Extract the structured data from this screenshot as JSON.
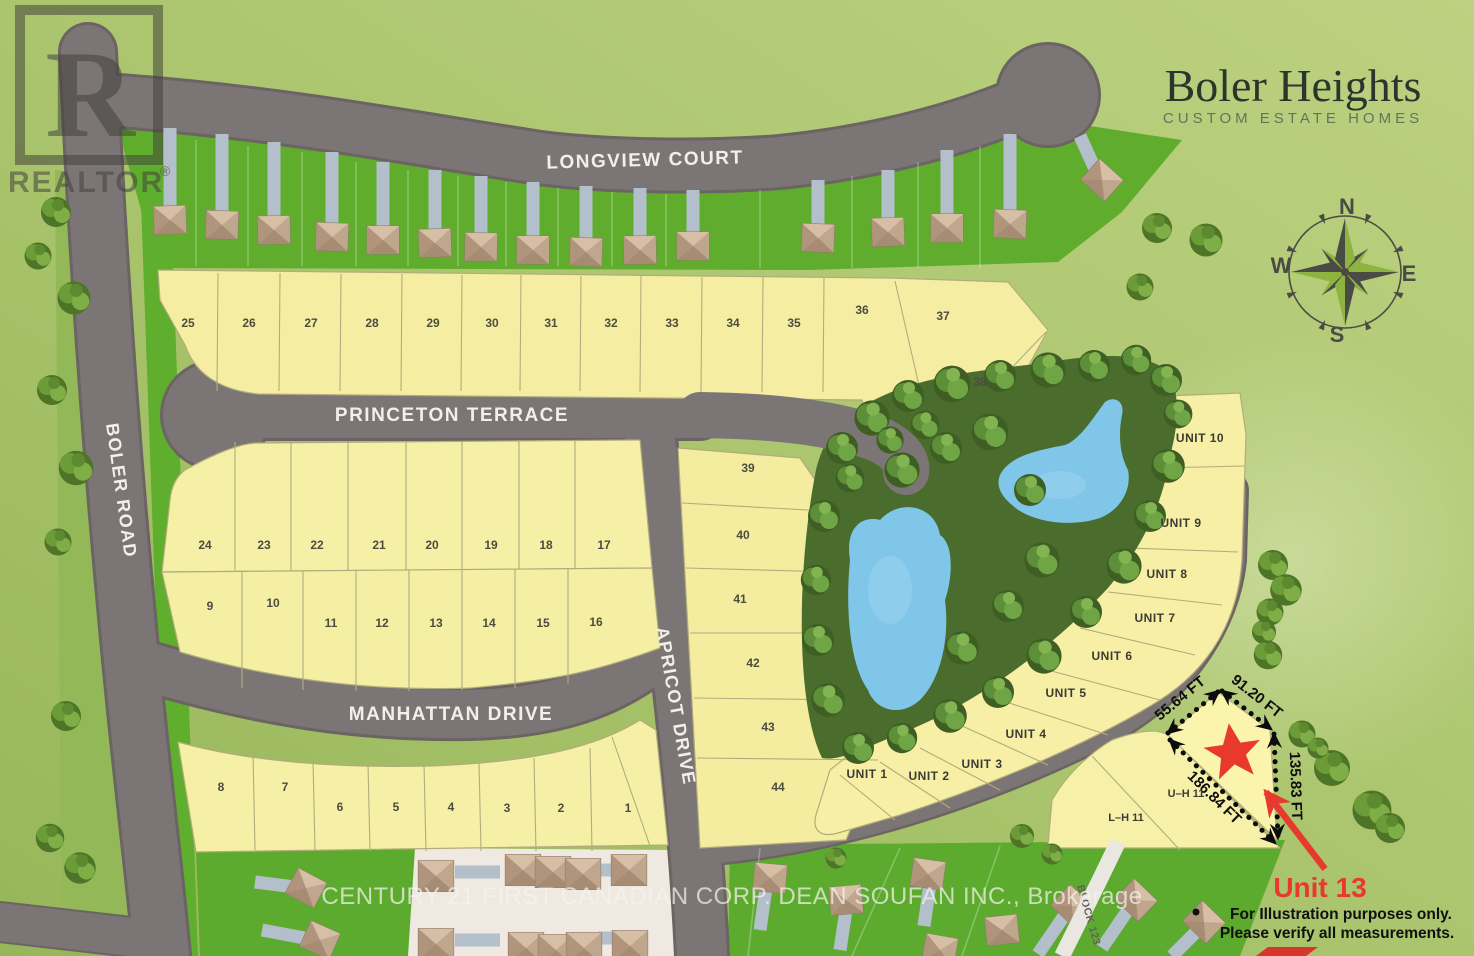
{
  "header": {
    "title": "Boler Heights",
    "subtitle": "CUSTOM ESTATE HOMES"
  },
  "compass": {
    "n": "N",
    "e": "E",
    "s": "S",
    "w": "W"
  },
  "streets": {
    "longview": "LONGVIEW COURT",
    "princeton": "PRINCETON TERRACE",
    "manhattan": "MANHATTAN DRIVE",
    "apricot": "APRICOT DRIVE",
    "boler": "BOLER ROAD",
    "block123": "BLOCK 123"
  },
  "lots": {
    "n1": "1",
    "n2": "2",
    "n3": "3",
    "n4": "4",
    "n5": "5",
    "n6": "6",
    "n7": "7",
    "n8": "8",
    "n9": "9",
    "n10": "10",
    "n11": "11",
    "n12": "12",
    "n13": "13",
    "n14": "14",
    "n15": "15",
    "n16": "16",
    "n17": "17",
    "n18": "18",
    "n19": "19",
    "n20": "20",
    "n21": "21",
    "n22": "22",
    "n23": "23",
    "n24": "24",
    "n25": "25",
    "n26": "26",
    "n27": "27",
    "n28": "28",
    "n29": "29",
    "n30": "30",
    "n31": "31",
    "n32": "32",
    "n33": "33",
    "n34": "34",
    "n35": "35",
    "n36": "36",
    "n37": "37",
    "n38": "38",
    "n39": "39",
    "n40": "40",
    "n41": "41",
    "n42": "42",
    "n43": "43",
    "n44": "44"
  },
  "units": {
    "u1": "UNIT 1",
    "u2": "UNIT 2",
    "u3": "UNIT 3",
    "u4": "UNIT 4",
    "u5": "UNIT 5",
    "u6": "UNIT 6",
    "u7": "UNIT 7",
    "u8": "UNIT 8",
    "u9": "UNIT 9",
    "u10": "UNIT 10",
    "uh11": "U–H 11",
    "lh11": "L–H 11"
  },
  "highlight": {
    "label": "Unit 13",
    "m_top_left": "55.64 FT",
    "m_top_right": "91.20 FT",
    "m_right": "135.83 FT",
    "m_diagonal": "186.84 FT",
    "note1": "For Illustration purposes only.",
    "note2": "Please verify all measurements."
  },
  "watermarks": {
    "realtor_letter": "R",
    "realtor": "REALTOR",
    "registered": "®",
    "brokerage": "CENTURY 21 FIRST CANADIAN CORP. DEAN SOUFAN INC., Brokerage"
  },
  "colors": {
    "accent_red": "#e8392e",
    "road_gray": "#7b7474",
    "lot_yellow": "#f6efa3",
    "bright_green": "#63b02d",
    "background_green": "#abc56f",
    "pond_blue": "#82c7ea"
  }
}
